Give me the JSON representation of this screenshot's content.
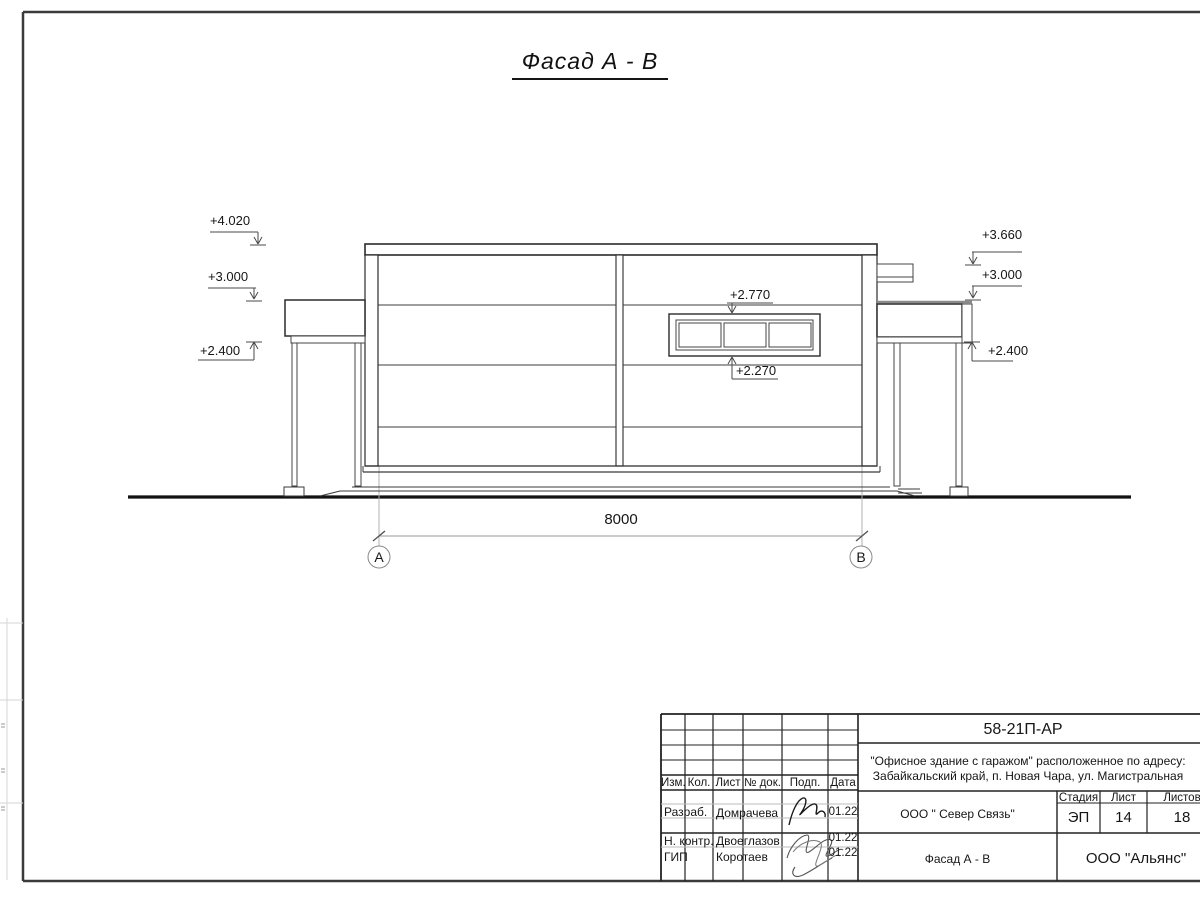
{
  "sheet": {
    "title": "Фасад А - В"
  },
  "drawing": {
    "elevations_left": [
      {
        "label": "+4.020"
      },
      {
        "label": "+3.000"
      },
      {
        "label": "+2.400"
      }
    ],
    "elevations_right": [
      {
        "label": "+3.660"
      },
      {
        "label": "+3.000"
      },
      {
        "label": "+2.400"
      }
    ],
    "window_elevations": {
      "top": "+2.770",
      "bottom": "+2.270"
    },
    "dimension": "8000",
    "axes": {
      "left": "А",
      "right": "В"
    }
  },
  "title_block": {
    "doc_number": "58-21П-АР",
    "project_line1": "\"Офисное здание с гаражом\" расположенное по адресу:",
    "project_line2": "Забайкальский край, п. Новая Чара, ул. Магистральная",
    "columns": {
      "izm": "Изм.",
      "kol": "Кол.",
      "list": "Лист",
      "doc": "№ док.",
      "podp": "Подп.",
      "data": "Дата"
    },
    "signature_rows": [
      {
        "role": "Разраб.",
        "name": "Домрачева",
        "date": "01.22"
      },
      {
        "role": "Н. контр.",
        "name": "Двоеглазов",
        "date": "01.22"
      },
      {
        "role": "ГИП",
        "name": "Коротаев",
        "date": "01.22"
      }
    ],
    "org": "ООО \" Север Связь\"",
    "drawing_title": "Фасад А - В",
    "stage_label": "Стадия",
    "stage": "ЭП",
    "sheet_label": "Лист",
    "sheet_num": "14",
    "sheets_label": "Листов",
    "sheets_total": "18",
    "company": "ООО \"Альянс\""
  }
}
